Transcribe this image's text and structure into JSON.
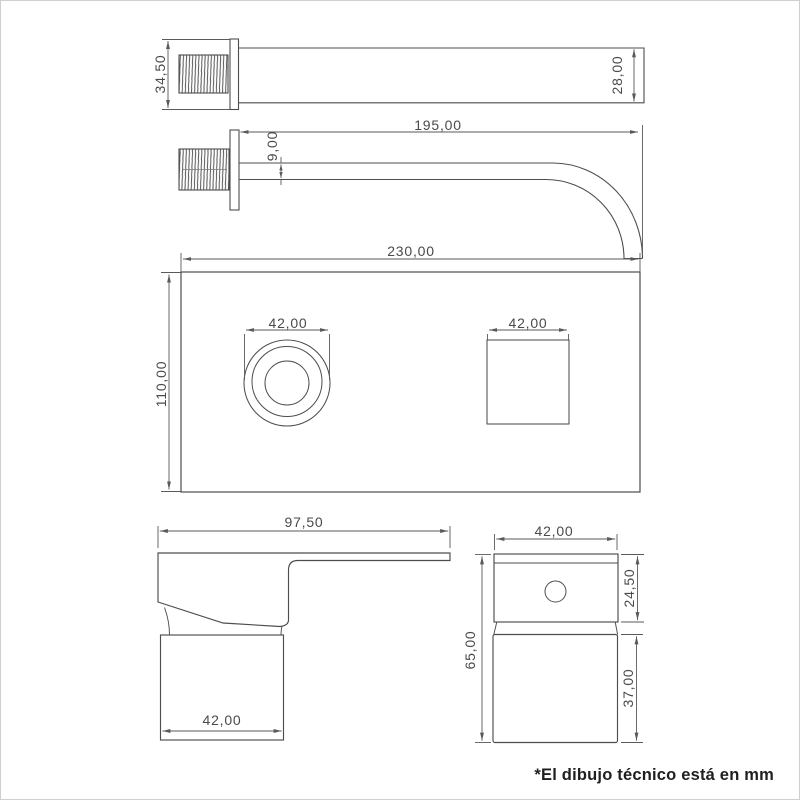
{
  "document": {
    "type": "technical-drawing",
    "units": "mm",
    "footer_note": "*El dibujo técnico está en mm"
  },
  "colors": {
    "background": "#ffffff",
    "frame_border": "#cfcfcf",
    "object_line": "#4d4d4d",
    "dimension_line": "#5a5a5a",
    "dimension_text": "#4a4a4a",
    "note_text": "#1f1f1f"
  },
  "views": {
    "spout_top": {
      "label": "spout top view",
      "dims": {
        "flange_height": "34,50",
        "spout_width": "28,00"
      }
    },
    "spout_side": {
      "label": "spout side view",
      "dims": {
        "projection_length": "195,00",
        "spout_thickness": "9,00"
      }
    },
    "wall_plate": {
      "label": "wall plate front view",
      "dims": {
        "plate_width": "230,00",
        "plate_height": "110,00",
        "knob_diameter": "42,00",
        "spout_cutout_width": "42,00"
      }
    },
    "handle_side": {
      "label": "handle side view",
      "dims": {
        "handle_depth": "97,50",
        "base_width": "42,00"
      }
    },
    "handle_front": {
      "label": "handle front view",
      "dims": {
        "body_width": "42,00",
        "total_height": "65,00",
        "cap_height": "24,50",
        "base_height": "37,00"
      }
    }
  }
}
